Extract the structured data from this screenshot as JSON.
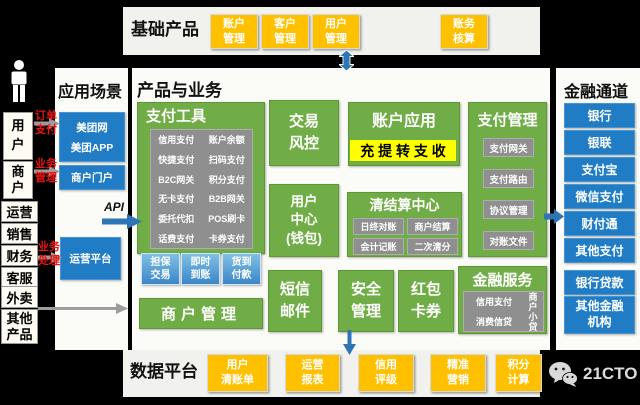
{
  "colors": {
    "green": "#70ad47",
    "blue": "#1f7cc5",
    "yellow": "#ffc000",
    "highlight": "#ffff00",
    "gray_box": "#8f8f8f",
    "red": "#ee1111",
    "arrow_blue": "#2e75b6",
    "arrow_gray": "#9c9c9c"
  },
  "top_panel": {
    "title": "基础产品",
    "boxes": [
      "账户\n管理",
      "客户\n管理",
      "用户\n管理",
      "账务\n核算"
    ]
  },
  "app_panel": {
    "title": "应用场景",
    "portal_lines": [
      "美团网",
      "美团APP"
    ],
    "merchant_portal": "商户门户",
    "ops_platform": "运营平台"
  },
  "actors": {
    "user": "用\n户",
    "merchant": "商\n户",
    "roles": [
      "运营",
      "销售",
      "财务",
      "客服"
    ],
    "others": [
      "外卖",
      "其他\n产品"
    ]
  },
  "labels": {
    "order_pay": "订单\n支付",
    "biz_mgmt": "业务\n管理",
    "biz_process": "业务\n处理",
    "api": "API"
  },
  "center": {
    "title": "产品与业务",
    "payment_tools": {
      "title": "支付工具",
      "col1": [
        "信用支付",
        "快捷支付",
        "B2C网关",
        "无卡支付",
        "委托代扣",
        "话费支付"
      ],
      "col2": [
        "账户余额",
        "扫码支付",
        "积分支付",
        "B2B网关",
        "POS刷卡",
        "卡券支付"
      ]
    },
    "trade_modes": [
      "担保\n交易",
      "即时\n到账",
      "货到\n付款"
    ],
    "merchant_mgmt": "商户管理",
    "risk": "交易\n风控",
    "user_center": "用户\n中心\n(钱包)",
    "account_app": {
      "title": "账户应用",
      "highlight": "充 提 转 支 收"
    },
    "clearing": {
      "title": "清结算中心",
      "items": [
        "日终对账",
        "商户结算",
        "会计记账",
        "二次清分"
      ]
    },
    "pay_mgmt": {
      "title": "支付管理",
      "items": [
        "支付网关",
        "支付路由",
        "协议管理",
        "对账文件"
      ]
    },
    "sms": "短信\n邮件",
    "security": "安全\n管理",
    "redpacket": "红包\n卡券",
    "fin_service": {
      "title": "金融服务",
      "items": [
        "信用支付",
        "消费信贷"
      ],
      "vertical": "商\n户\n小\n贷"
    }
  },
  "right_panel": {
    "title": "金融通道",
    "channels": [
      "银行",
      "银联",
      "支付宝",
      "微信支付",
      "财付通",
      "其他支付"
    ],
    "lending": [
      "银行贷款",
      "其他金融\n机构"
    ]
  },
  "bottom_panel": {
    "title": "数据平台",
    "boxes": [
      "用户\n清账单",
      "运营\n报表",
      "信用\n评级",
      "精准\n营销",
      "积分\n计算"
    ]
  },
  "logo": {
    "text": "21CTO"
  }
}
